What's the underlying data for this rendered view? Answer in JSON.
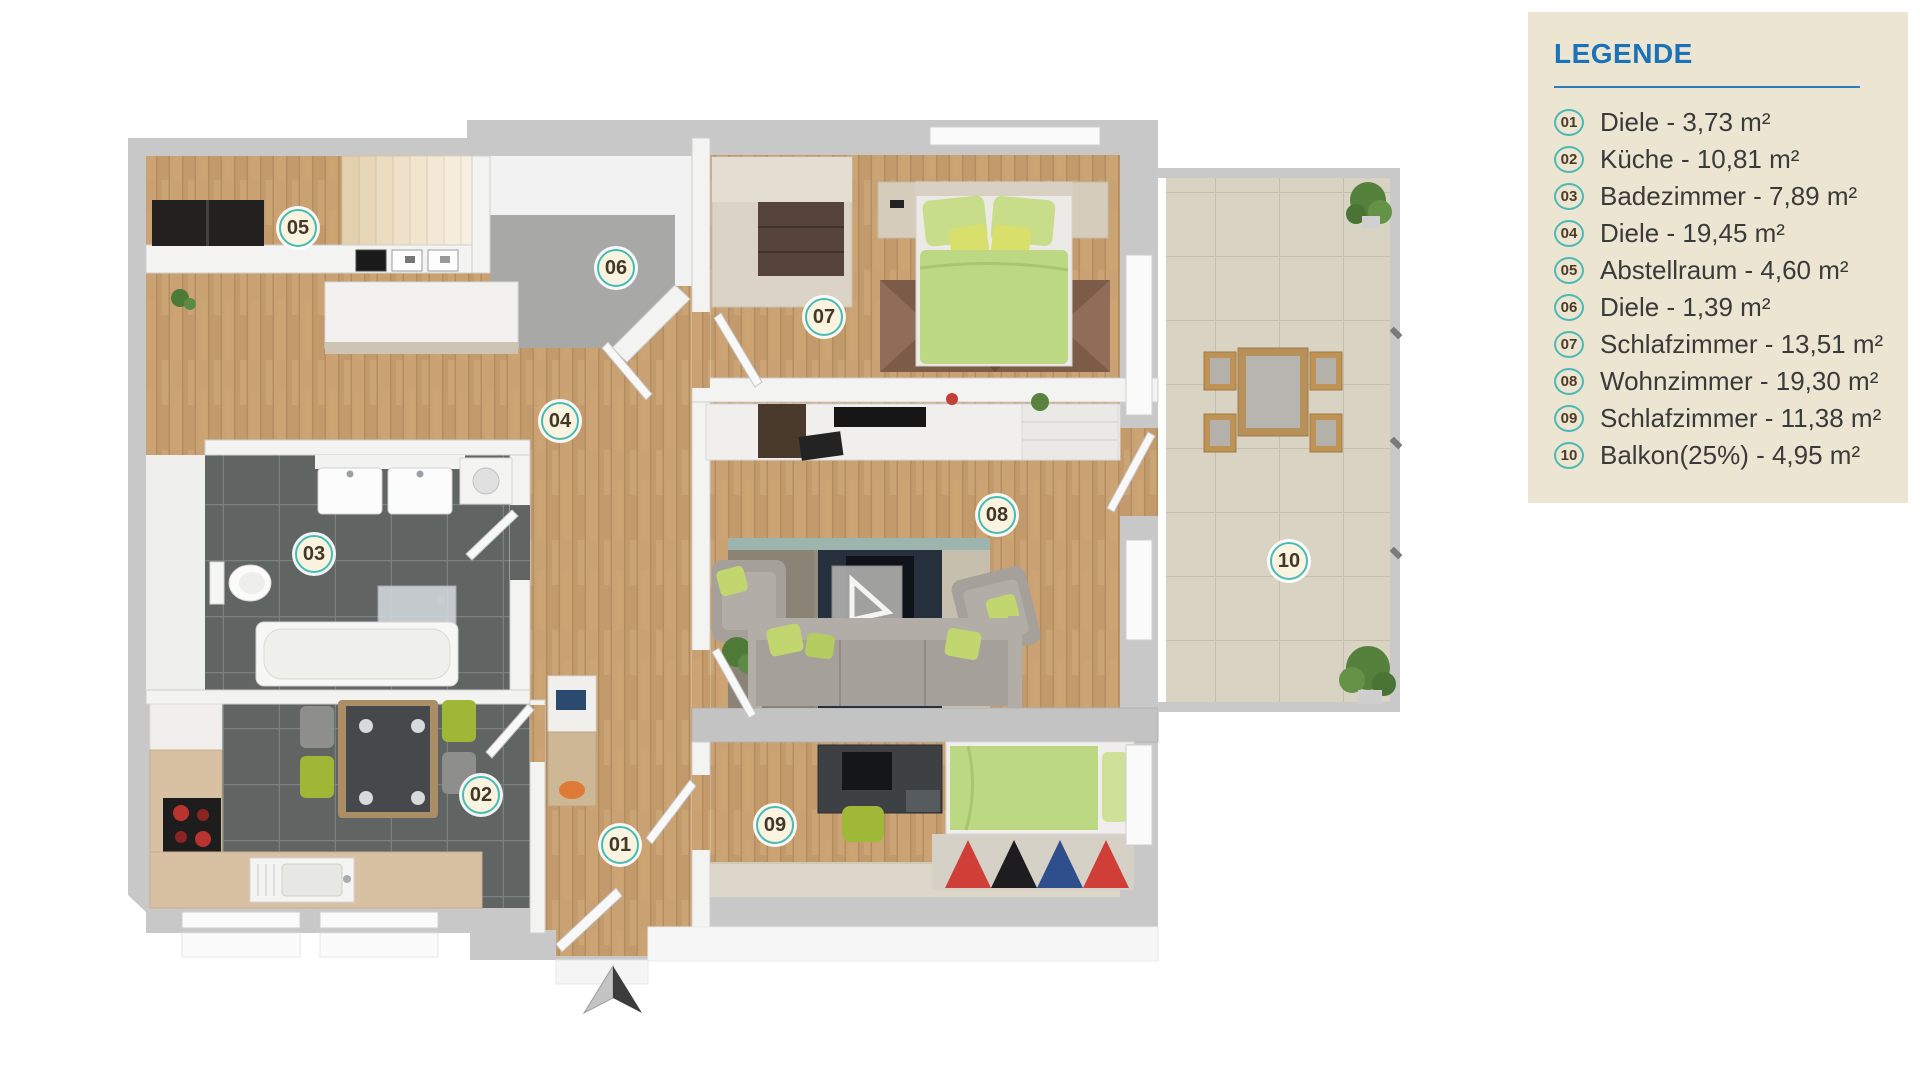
{
  "legend": {
    "title": "LEGENDE",
    "items": [
      {
        "number": "01",
        "label": "Diele - 3,73 m²"
      },
      {
        "number": "02",
        "label": "Küche - 10,81 m²"
      },
      {
        "number": "03",
        "label": "Badezimmer - 7,89 m²"
      },
      {
        "number": "04",
        "label": "Diele - 19,45 m²"
      },
      {
        "number": "05",
        "label": "Abstellraum - 4,60 m²"
      },
      {
        "number": "06",
        "label": "Diele - 1,39 m²"
      },
      {
        "number": "07",
        "label": "Schlafzimmer - 13,51 m²"
      },
      {
        "number": "08",
        "label": "Wohnzimmer - 19,30 m²"
      },
      {
        "number": "09",
        "label": "Schlafzimmer - 11,38 m²"
      },
      {
        "number": "10",
        "label": "Balkon(25%) - 4,95 m²"
      }
    ]
  },
  "plan": {
    "markers": [
      {
        "number": "01",
        "name": "Diele",
        "x": 620,
        "y": 845
      },
      {
        "number": "02",
        "name": "Küche",
        "x": 481,
        "y": 795
      },
      {
        "number": "03",
        "name": "Badezimmer",
        "x": 314,
        "y": 554
      },
      {
        "number": "04",
        "name": "Diele",
        "x": 560,
        "y": 421
      },
      {
        "number": "05",
        "name": "Abstellraum",
        "x": 298,
        "y": 228
      },
      {
        "number": "06",
        "name": "Diele",
        "x": 616,
        "y": 268
      },
      {
        "number": "07",
        "name": "Schlafzimmer",
        "x": 824,
        "y": 317
      },
      {
        "number": "08",
        "name": "Wohnzimmer",
        "x": 997,
        "y": 515
      },
      {
        "number": "09",
        "name": "Schlafzimmer",
        "x": 775,
        "y": 825
      },
      {
        "number": "10",
        "name": "Balkon",
        "x": 1289,
        "y": 561
      }
    ]
  },
  "colors": {
    "legend_bg": "#ece5d1",
    "legend_title_blue": "#1a73b8",
    "badge_ring_teal": "#4cb9b4",
    "badge_bg_cream": "#faf3e0",
    "wall_gray": "#c8c8c8",
    "wood_floor": "#c9a173",
    "dark_tile": "#606563",
    "balcony_tile": "#d9d3c3",
    "carpet_gray": "#a8a8a6",
    "furniture_green": "#bdd883"
  }
}
